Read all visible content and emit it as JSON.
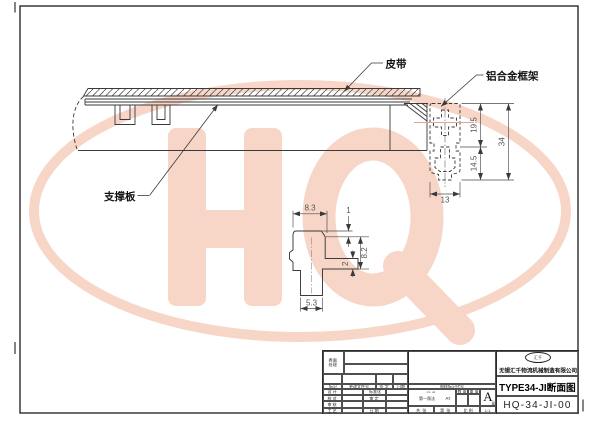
{
  "watermark": {
    "text": "HQ",
    "color": "#f7d6c7"
  },
  "colors": {
    "line": "#3a3a3a",
    "dim_text": "#555555",
    "centerline": "#e8a28e"
  },
  "labels": {
    "belt": "皮带",
    "alu_frame": "铝合金框架",
    "support_plate": "支撑板"
  },
  "dims": {
    "frame_upper": "19.5",
    "frame_total": "34",
    "frame_lower": "14.5",
    "frame_width": "13",
    "detail_top_width": "8.3",
    "detail_step": "1",
    "detail_height": "8.2",
    "detail_flange_th": "2",
    "detail_bottom_width": "5.3"
  },
  "title_block": {
    "surface_treatment": "表面处理",
    "header": {
      "mark": "标记",
      "change_doc": "更改文件号",
      "sign": "签 字",
      "date": "日期"
    },
    "mid_header": "图样标记代号",
    "sign_rows": [
      {
        "l": "设 计",
        "r": "标准化"
      },
      {
        "l": "校 对",
        "r": "审 定"
      },
      {
        "l": "审 核",
        "r": ""
      },
      {
        "l": "工 艺",
        "r": "日 期"
      }
    ],
    "projection": {
      "method": "第一角法",
      "sheet": "A3"
    },
    "qty": "数 量",
    "weight": "重 量",
    "grade": "A",
    "grade_note": "级",
    "total": "共  张",
    "page": "第  张",
    "scale_label": "比 例",
    "scale": "1:1",
    "logo": "汇千",
    "company": "无锡汇千物流机械制造有限公司",
    "title": "TYPE34-JI断面图",
    "drawing_no": "HQ-34-JI-00"
  }
}
